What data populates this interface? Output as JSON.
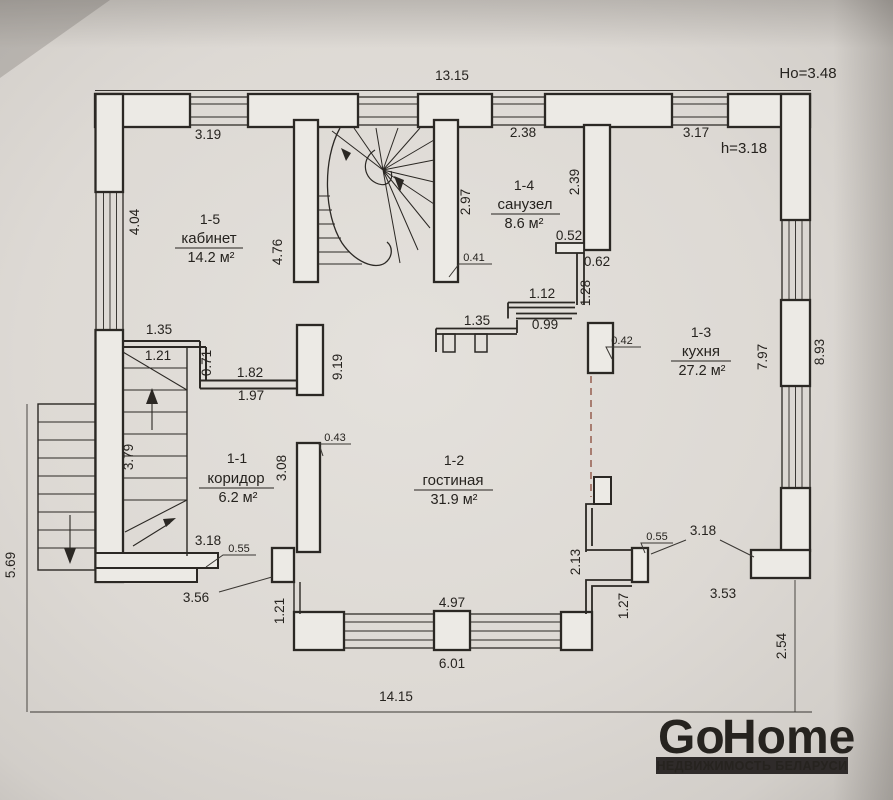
{
  "title": {
    "floor_height": "Но=3.48",
    "room_height": "h=3.18"
  },
  "overall": {
    "top": "13.15",
    "bottom": "14.15",
    "left": "5.69",
    "right": "8.93",
    "right_offset": "2.54"
  },
  "rooms": {
    "cabinet": {
      "id": "1-5",
      "name": "кабинет",
      "area": "14.2 м²"
    },
    "bathroom": {
      "id": "1-4",
      "name": "санузел",
      "area": "8.6 м²"
    },
    "kitchen": {
      "id": "1-3",
      "name": "кухня",
      "area": "27.2 м²"
    },
    "hallway": {
      "id": "1-1",
      "name": "коридор",
      "area": "6.2 м²"
    },
    "living": {
      "id": "1-2",
      "name": "гостиная",
      "area": "31.9 м²"
    }
  },
  "dims": {
    "cabinet_top": "3.19",
    "cabinet_left": "4.04",
    "cabinet_right": "4.76",
    "bathroom_top": "2.38",
    "kitchen_top": "3.17",
    "stair_right": "2.97",
    "bathroom_inner_right": "2.39",
    "stair_pier": "0.41",
    "bath_step_w": "0.52",
    "bath_step_h": "0.62",
    "bath_wall": "1.28",
    "entry_top": "1.12",
    "entry_bottom": "0.99",
    "entry_left": "1.35",
    "kitchen_pier": "0.42",
    "kitchen_inner_right": "7.97",
    "part_top": "1.35",
    "part_inner": "1.21",
    "part_drop": "0.71",
    "part_right_a": "1.82",
    "part_right_b": "1.97",
    "hall_pier": "9.19",
    "stairs_run": "3.79",
    "hall_wall": "3.08",
    "hall_wall_pier": "0.43",
    "hall_bottom": "3.18",
    "hall_step": "0.55",
    "hall_outer": "3.56",
    "living_left_jog": "1.21",
    "living_window": "4.97",
    "living_bottom": "6.01",
    "living_right_jog": "1.27",
    "chimney": "2.13",
    "porch_step": "0.55",
    "porch_opening": "3.18",
    "porch_bottom": "3.53"
  },
  "logo": {
    "brand_red": "Go",
    "brand_dark": "Home",
    "tagline": "НЕДВИЖИМОСТЬ БЕЛАРУСИ",
    "red": "#c0272d",
    "dark": "#2f2b2a"
  }
}
